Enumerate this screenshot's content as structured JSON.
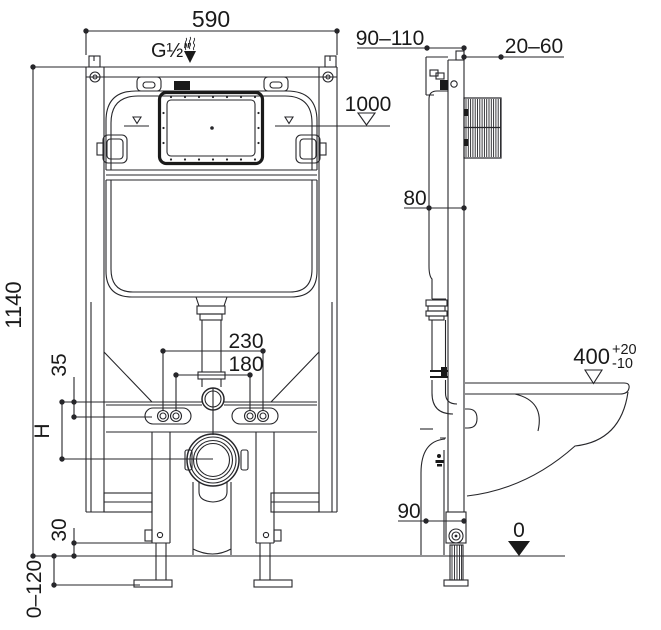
{
  "dims": {
    "front": {
      "top_width": "590",
      "inlet": "G½″",
      "height": "1140",
      "bolt_outer": "230",
      "bolt_inner": "180",
      "plate_offset": "35",
      "outlet_height": "H",
      "leg_exposed": "30",
      "foot_range": "0–120"
    },
    "side": {
      "depth_range": "90–110",
      "wall_range": "20–60",
      "ref_height": "1000",
      "tank_depth": "80",
      "pan_height": "400",
      "pan_tol_up": "+20",
      "pan_tol_down": "-10",
      "bottom_depth": "90",
      "floor": "0"
    }
  }
}
